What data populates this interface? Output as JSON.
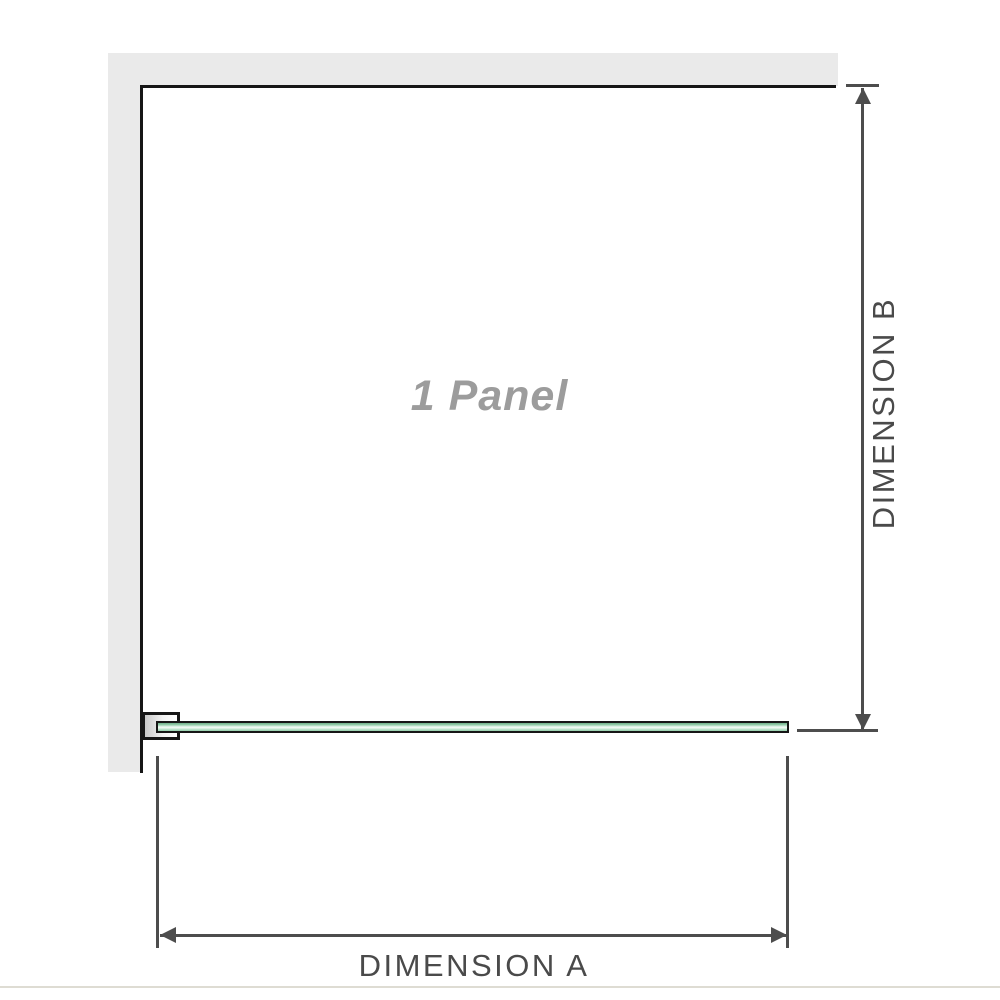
{
  "diagram": {
    "panel_label": "1 Panel",
    "dimension_a_label": "DIMENSION A",
    "dimension_b_label": "DIMENSION B"
  },
  "icons": {
    "arrow_up": "triangle-up",
    "arrow_down": "triangle-down",
    "arrow_left": "triangle-left",
    "arrow_right": "triangle-right"
  },
  "colors": {
    "wall_fill": "#eaeaea",
    "outline": "#161616",
    "dimension_line": "#4d4d4d",
    "label_text": "#4a4a4a",
    "panel_label_text": "#9c9c9c",
    "glass_green": "#93cdaa",
    "glass_highlight": "#e9f7ee",
    "baseline_rule": "#dedcd3"
  }
}
